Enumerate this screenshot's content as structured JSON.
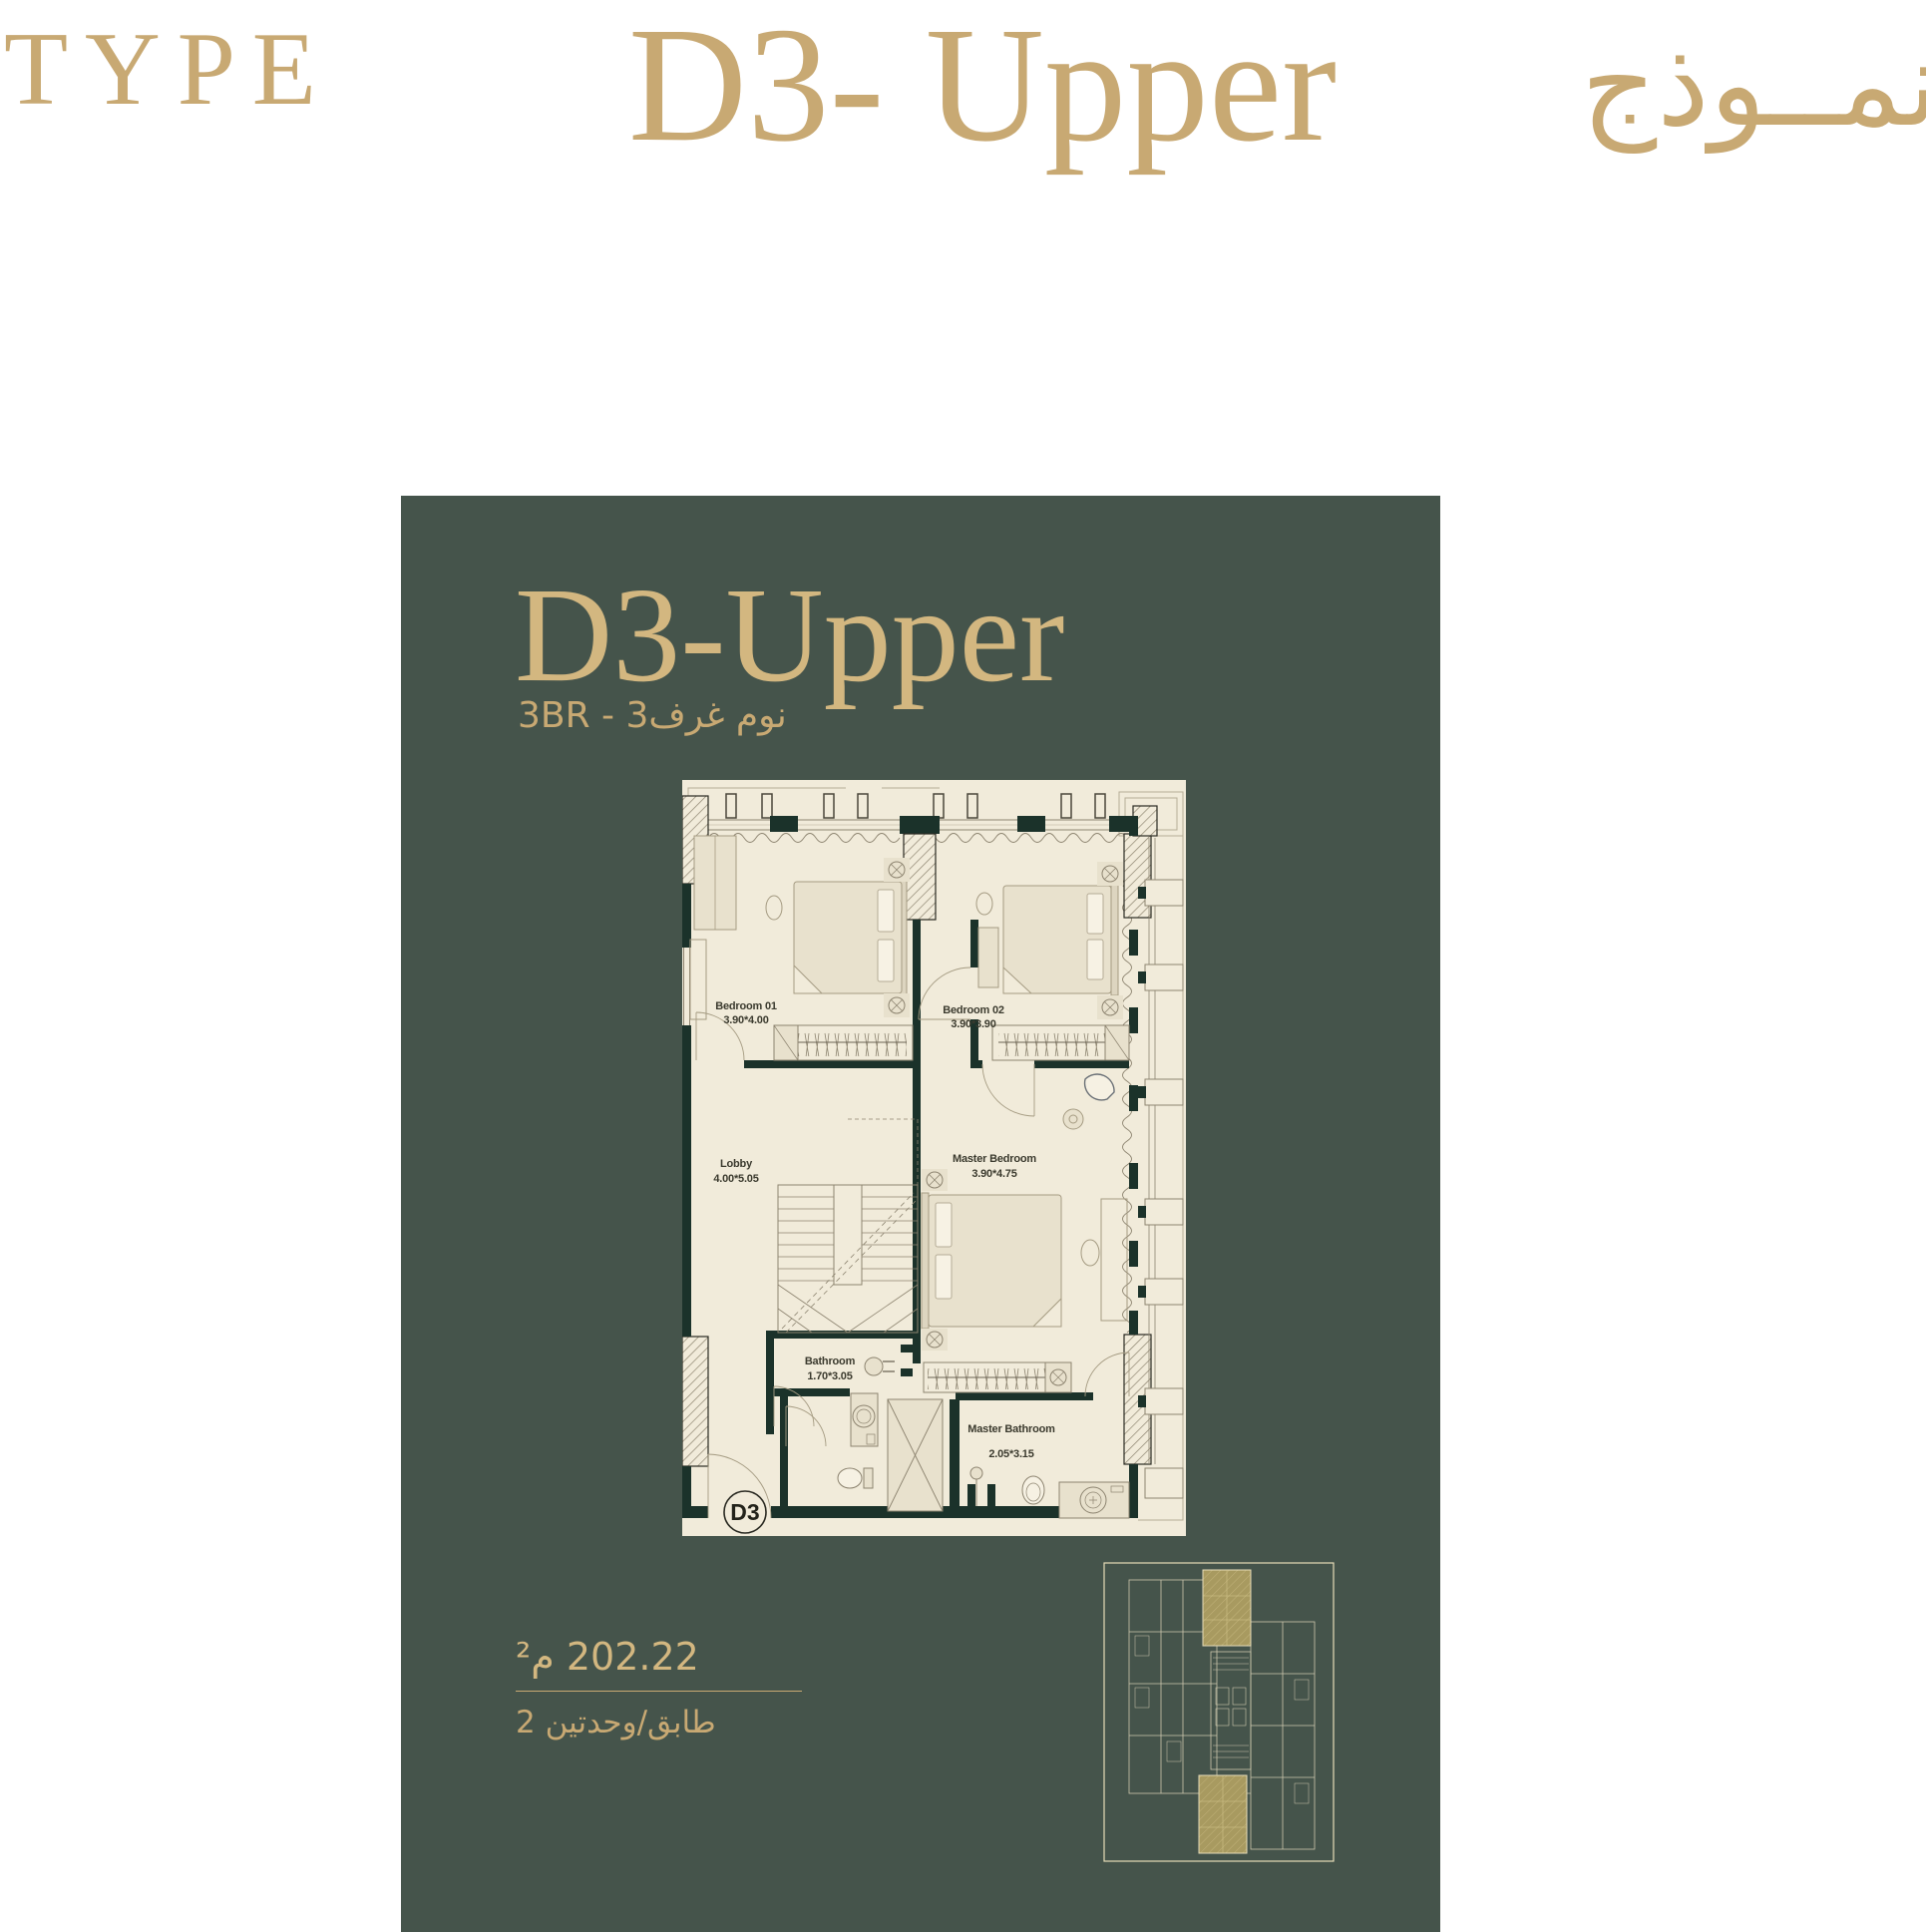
{
  "colors": {
    "gold": "#c8a973",
    "goldlight": "#d3b780",
    "green": "#45544b",
    "wall": "#1b322a",
    "cream": "#f1ebda",
    "furn": "#e8e1cd",
    "line": "#8d8470",
    "linelight": "#b5ac96",
    "label": "#3b3a2e",
    "keyline": "#ddd5b9",
    "keygold": "#a89a60"
  },
  "header": {
    "type_label": "TYPE",
    "title": "D3- Upper",
    "title_ar": "نمــوذج"
  },
  "card": {
    "title": "D3-Upper",
    "subtitle": "3BR - 3غرف‎ نوم",
    "area_value": "202.22 م²",
    "units_per_floor": "2 وحدتين‎/‎طابق",
    "badge": "D3"
  },
  "plan": {
    "rooms": [
      {
        "name": "Bedroom 01",
        "dims": "3.90*4.00"
      },
      {
        "name": "Bedroom 02",
        "dims": "3.90*3.90"
      },
      {
        "name": "Lobby",
        "dims": "4.00*5.05"
      },
      {
        "name": "Master Bedroom",
        "dims": "3.90*4.75"
      },
      {
        "name": "Bathroom",
        "dims": "1.70*3.05"
      },
      {
        "name": "Master Bathroom",
        "dims": "2.05*3.15"
      }
    ]
  }
}
